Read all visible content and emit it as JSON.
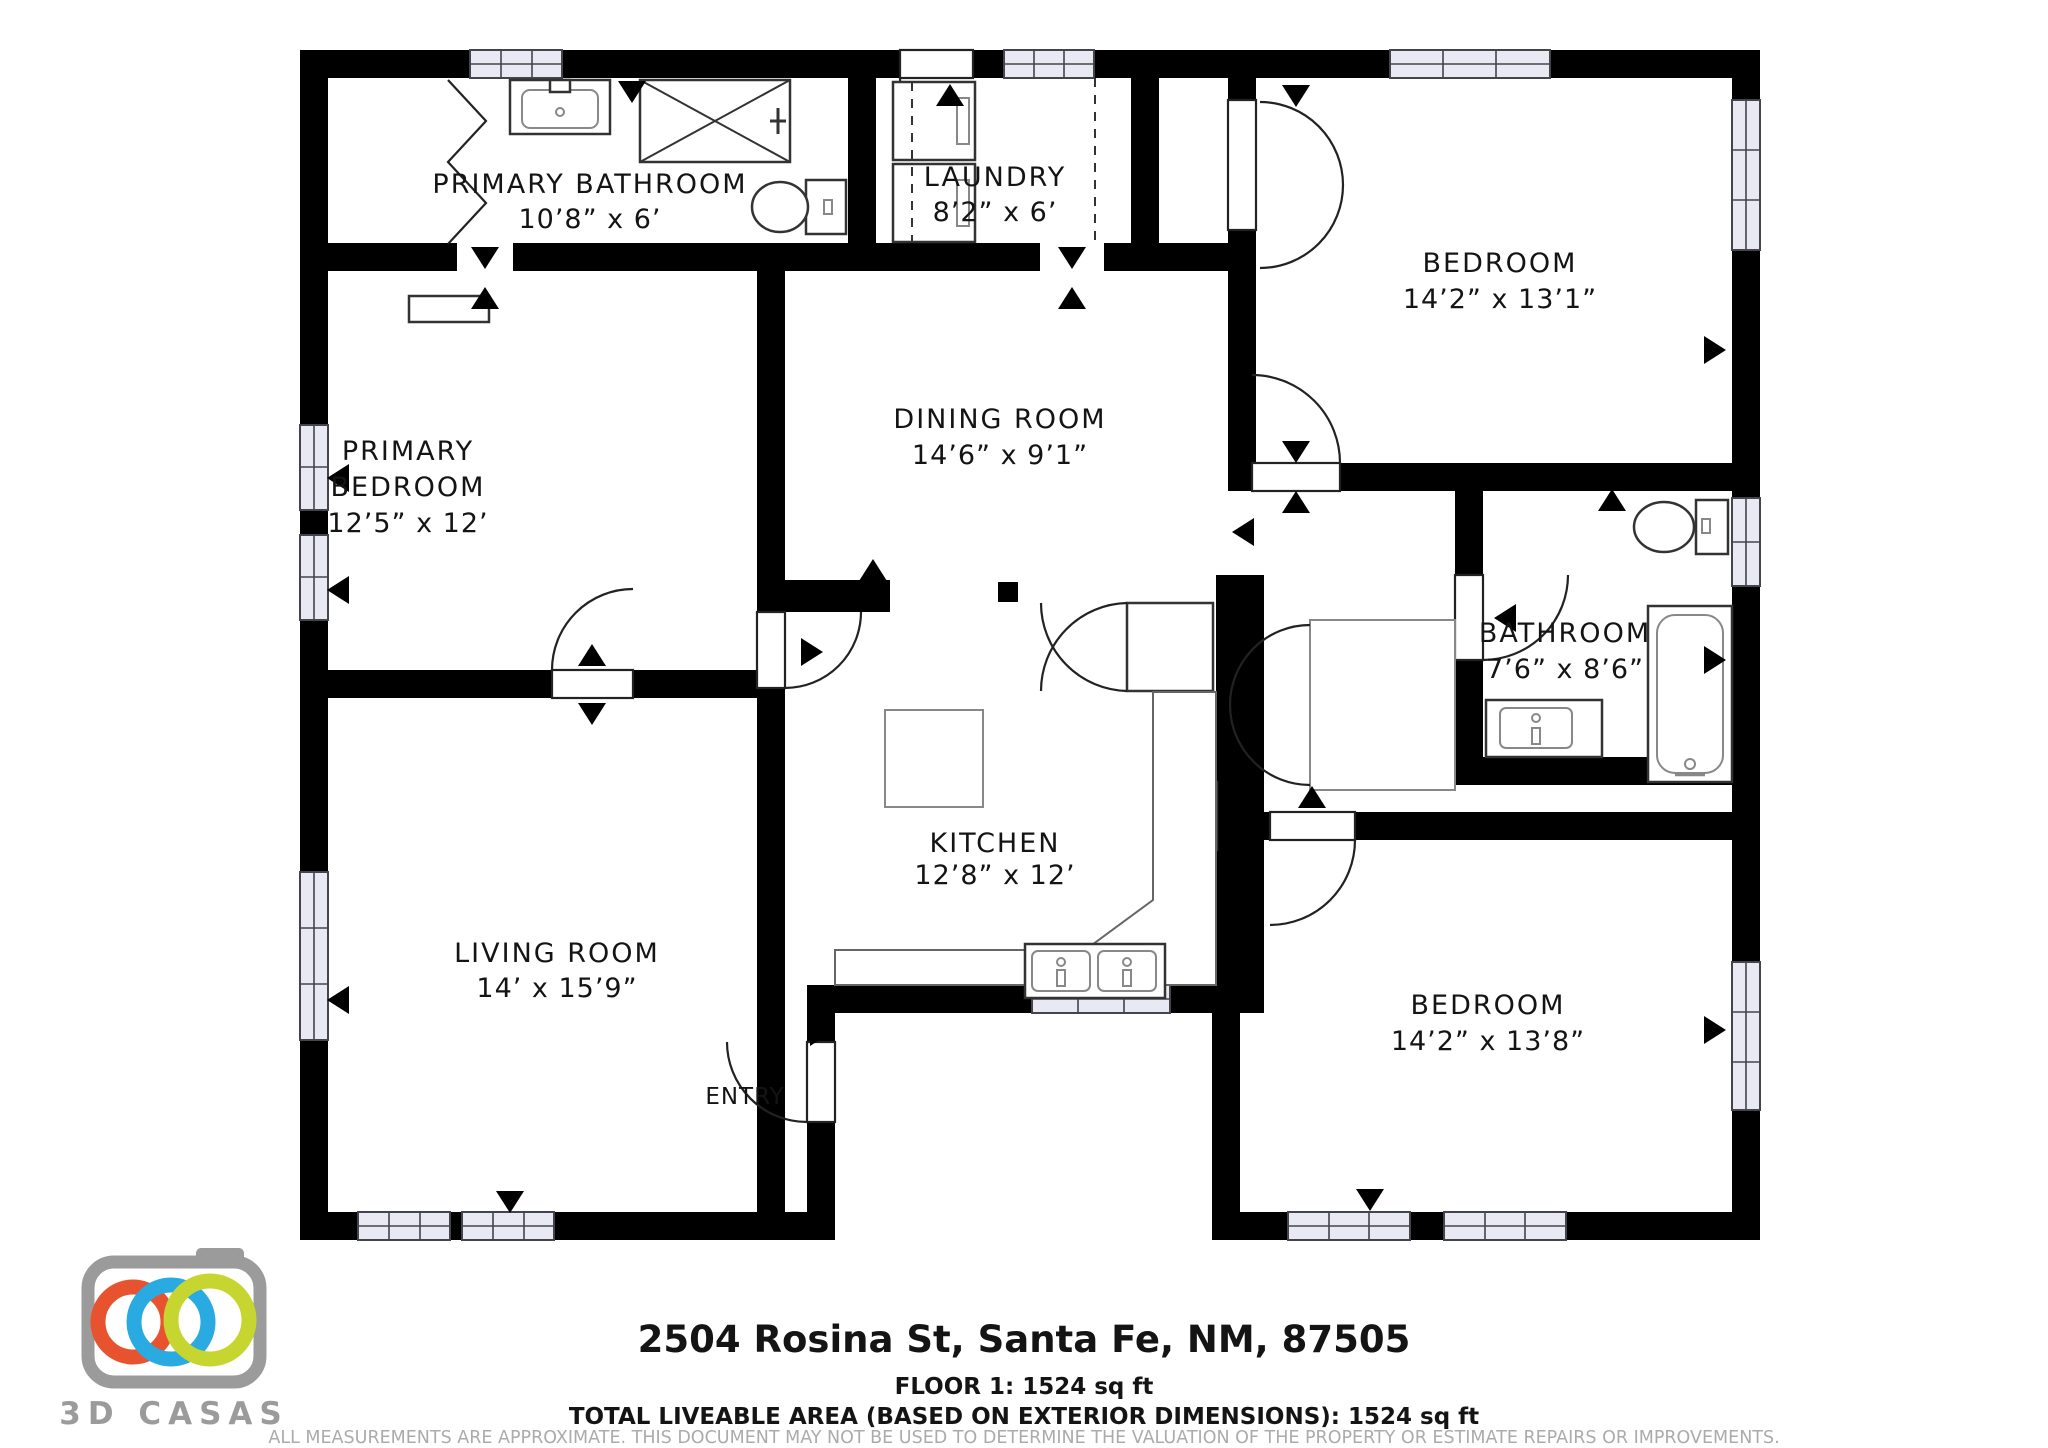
{
  "rooms": {
    "primary_bathroom": {
      "name": "PRIMARY BATHROOM",
      "dims": "10’8” x 6’"
    },
    "laundry": {
      "name": "LAUNDRY",
      "dims": "8’2” x 6’"
    },
    "bedroom_top": {
      "name": "BEDROOM",
      "dims": "14’2” x 13’1”"
    },
    "primary_bedroom": {
      "name_line1": "PRIMARY",
      "name_line2": "BEDROOM",
      "dims": "12’5” x 12’"
    },
    "dining_room": {
      "name": "DINING ROOM",
      "dims": "14’6” x 9’1”"
    },
    "bathroom": {
      "name": "BATHROOM",
      "dims": "7’6” x 8’6”"
    },
    "kitchen": {
      "name": "KITCHEN",
      "dims": "12’8” x 12’"
    },
    "living_room": {
      "name": "LIVING ROOM",
      "dims": "14’ x 15’9”"
    },
    "bedroom_bottom": {
      "name": "BEDROOM",
      "dims": "14’2” x 13’8”"
    },
    "entry": {
      "name": "ENTRY"
    }
  },
  "footer": {
    "address": "2504 Rosina St, Santa Fe, NM, 87505",
    "floor": "FLOOR 1: 1524 sq ft",
    "total": "TOTAL LIVEABLE AREA (BASED ON EXTERIOR DIMENSIONS): 1524 sq ft",
    "disclaimer_line1": "ALL MEASUREMENTS ARE APPROXIMATE. THIS DOCUMENT MAY NOT BE USED TO DETERMINE THE VALUATION OF THE PROPERTY OR ESTIMATE REPAIRS OR IMPROVEMENTS.",
    "disclaimer_line2": "ALL PARTIES USING THIS DOCUMENT AGREE TO TAKE THEIR OWN MEASUREMENTS IN ORDER TO DETERMINE THE LAYOUT AND SIZE OF THE PROPERTY."
  },
  "logo": {
    "text": "3D CASAS"
  },
  "colors": {
    "wall": "#000000",
    "window_fill": "#e9e9f4",
    "logo_gray": "#9b9b9b",
    "ring_orange": "#e8532f",
    "ring_blue": "#29abe2",
    "ring_yellow": "#c7d530",
    "disclaimer_gray": "#ababab"
  }
}
